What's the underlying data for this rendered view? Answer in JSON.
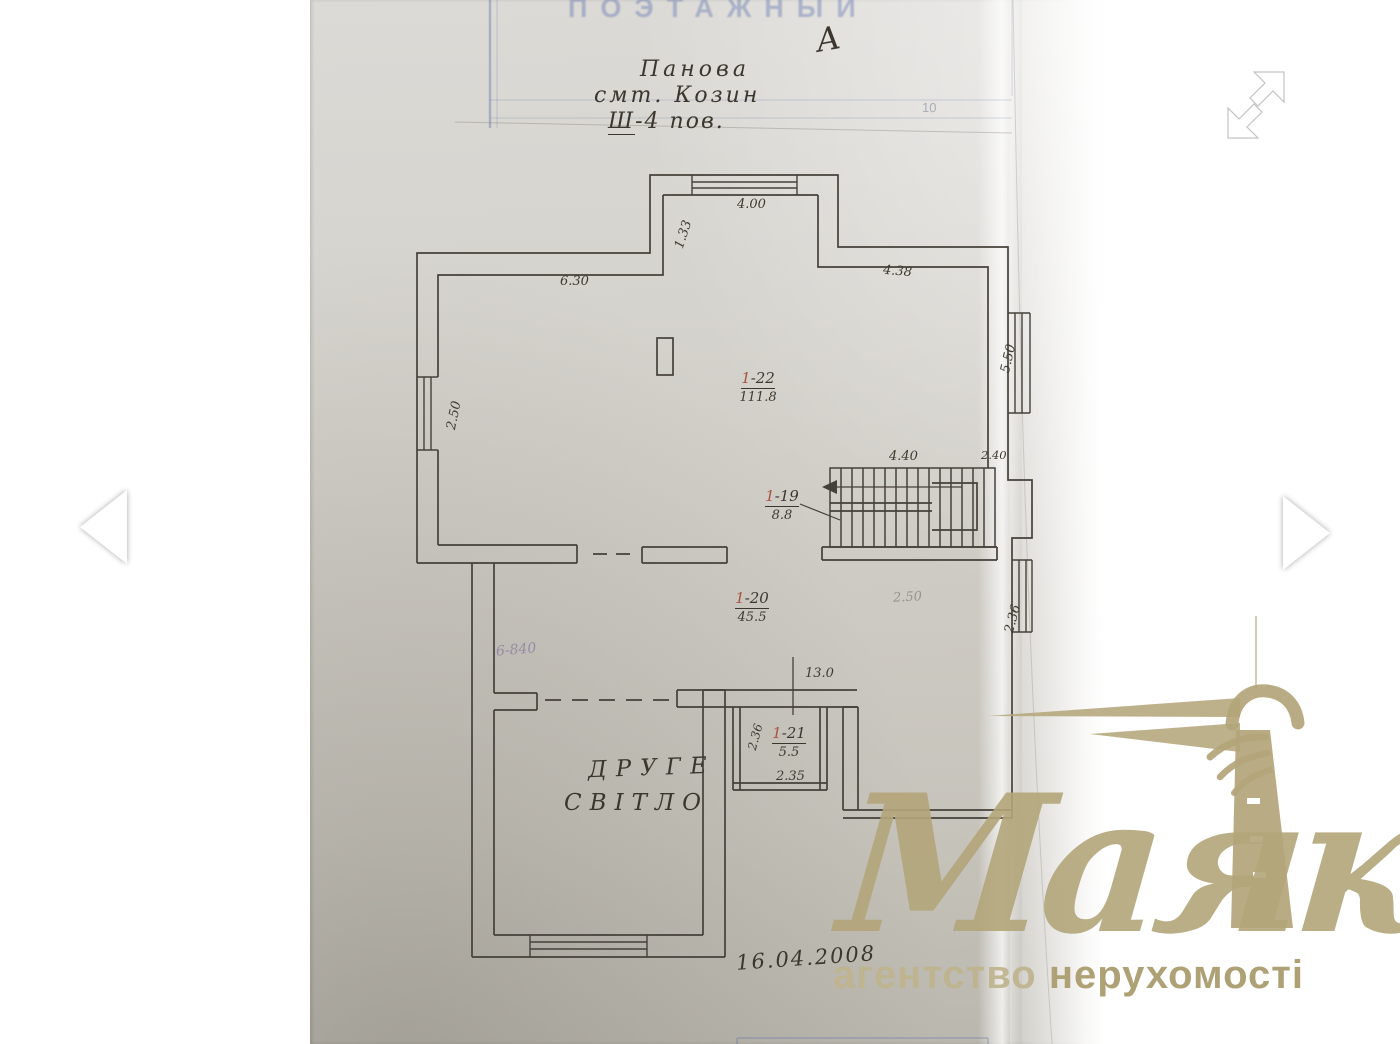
{
  "viewer": {
    "icons": {
      "prev": "chevron-left-icon",
      "next": "chevron-right-icon",
      "expand": "fullscreen-expand-icon"
    }
  },
  "document": {
    "stamp": {
      "title": "ПОЭТАЖНЫЙ",
      "corner_number": "10"
    },
    "annotations": {
      "letter": "А",
      "street": "Панова",
      "settlement": "смт. Козин",
      "floor_prefix": "Ш",
      "floor_rest": "-4 пов.",
      "note": "6-840",
      "date": "16.04.2008"
    },
    "labels": {
      "second_light_line1": "ДРУГЕ",
      "second_light_line2": "СВІТЛО"
    },
    "rooms": {
      "r22": {
        "prefix": "1",
        "suffix": "-22",
        "area": "111.8"
      },
      "r19": {
        "prefix": "1",
        "suffix": "-19",
        "area": "8.8"
      },
      "r20": {
        "prefix": "1",
        "suffix": "-20",
        "area": "45.5"
      },
      "r21": {
        "prefix": "1",
        "suffix": "-21",
        "area": "5.5"
      }
    },
    "dimensions": {
      "bay_width": "4.00",
      "bay_depth": "1.33",
      "wall_top_left": "6.30",
      "wall_top_right": "4.38",
      "window_left": "2.50",
      "window_right_upper": "5.50",
      "stair_width": "4.40",
      "stair_corner": "2.40",
      "window_right_lower": "2.36",
      "height_mark": "2.50",
      "opening": "13.0",
      "room21_depth": "2.36",
      "room21_width": "2.35"
    },
    "ink_color": "#3c372e",
    "stamp_color": "#6074b0"
  },
  "watermark": {
    "brand": "Маяк",
    "tagline_word1": "агентство",
    "tagline_word2": "нерухомості",
    "color": "#b5a77e",
    "icon": "lighthouse-icon"
  }
}
